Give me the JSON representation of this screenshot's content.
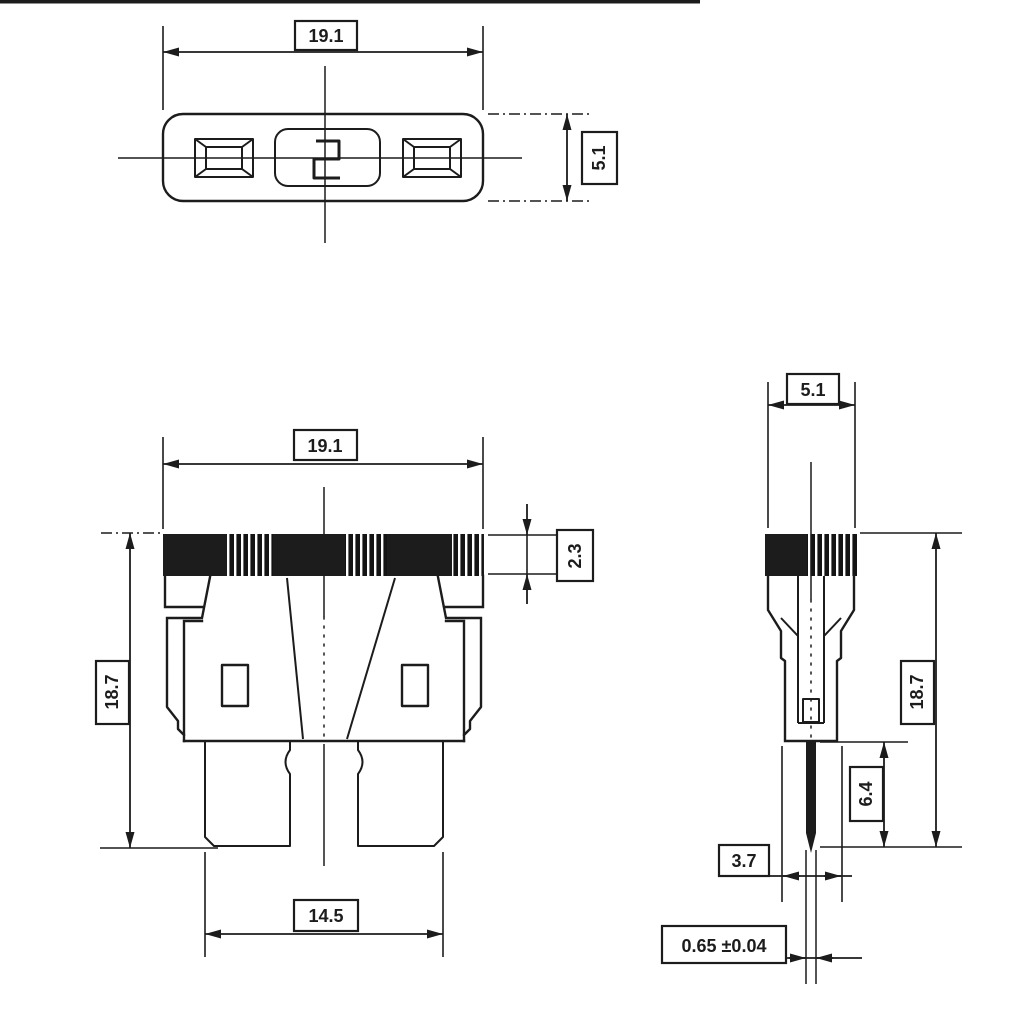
{
  "document": {
    "kind": "engineering dimension drawing",
    "subject": "blade fuse shown in three orthographic views"
  },
  "labels": {
    "top_width": "19.1",
    "top_height": "5.1",
    "front_width": "19.1",
    "front_height": "18.7",
    "front_cap_height": "2.3",
    "front_blade_span": "14.5",
    "side_width": "5.1",
    "side_height": "18.7",
    "side_blade_length": "6.4",
    "side_depth": "3.7",
    "side_blade_thickness": "0.65 ±0.04"
  },
  "colors": {
    "line": "#1c1c1c",
    "background": "#ffffff"
  }
}
